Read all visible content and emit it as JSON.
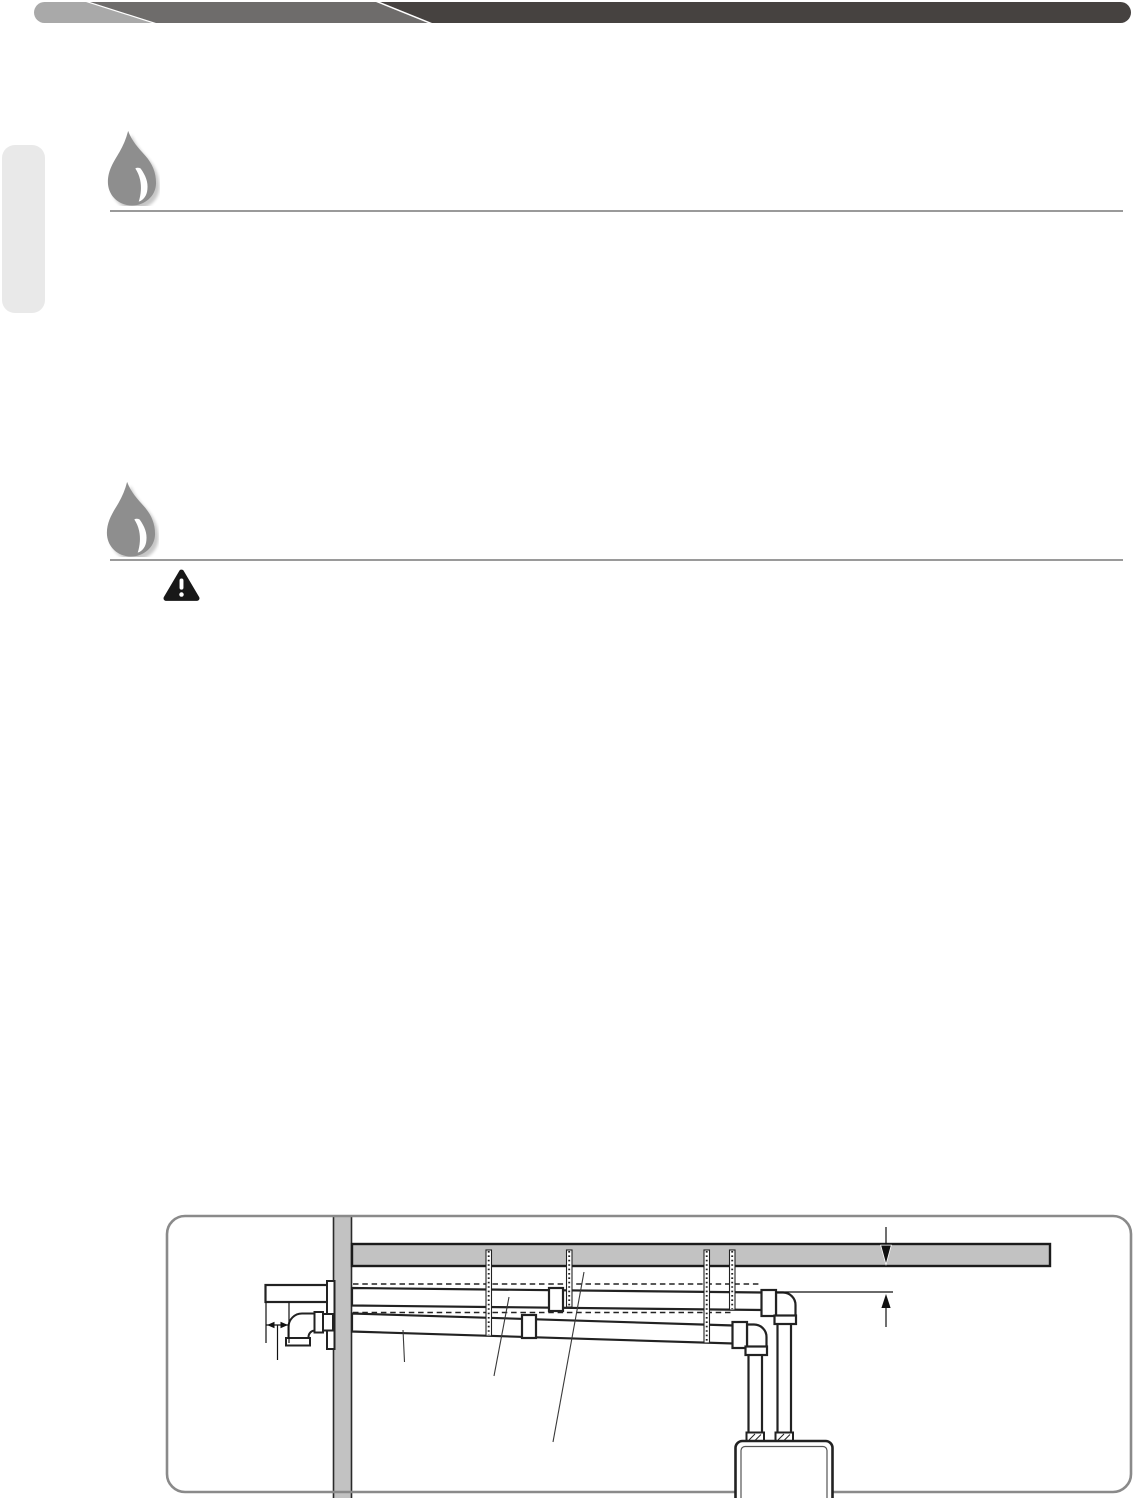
{
  "page": {
    "kind": "installation-manual-page",
    "width": 1137,
    "height": 1498,
    "background": "#ffffff",
    "visible_text": ""
  },
  "header": {
    "style": "three-segment-angled-banner",
    "divider_color": "#ffffff",
    "segments": [
      {
        "name": "left-segment",
        "color": "#a9a9a9"
      },
      {
        "name": "middle-segment",
        "color": "#6e6c6b"
      },
      {
        "name": "right-segment",
        "color": "#464240"
      }
    ]
  },
  "side_tab": {
    "color": "#e9e9e9"
  },
  "sections": [
    {
      "icon": "water-drop-icon",
      "icon_color": "#8e8e8e",
      "rule_color": "#9a9a9a"
    },
    {
      "icon": "water-drop-icon",
      "icon_color": "#8e8e8e",
      "rule_color": "#9a9a9a",
      "callout_icon": "warning-triangle-icon",
      "callout_icon_color": "#181818"
    }
  ],
  "figure": {
    "type": "technical-illustration",
    "subject": "horizontal-vent-piping-to-tankless-water-heater",
    "frame_color": "#8a8a8a",
    "line_color": "#222222",
    "surface_color": "#c2c2c2",
    "parts": [
      "exterior-wall",
      "ceiling",
      "vent-termination-stub",
      "wall-plate",
      "intake-elbow",
      "exhaust-pipe-run",
      "intake-pipe-run",
      "pipe-coupler",
      "hanger-strap",
      "down-elbow",
      "vertical-pipe",
      "water-heater",
      "flue-adapter",
      "slope-reference-dashed-line",
      "ceiling-pointer-arrow",
      "clearance-dimension-arrow",
      "offset-dimension-arrows",
      "leader-line"
    ]
  }
}
